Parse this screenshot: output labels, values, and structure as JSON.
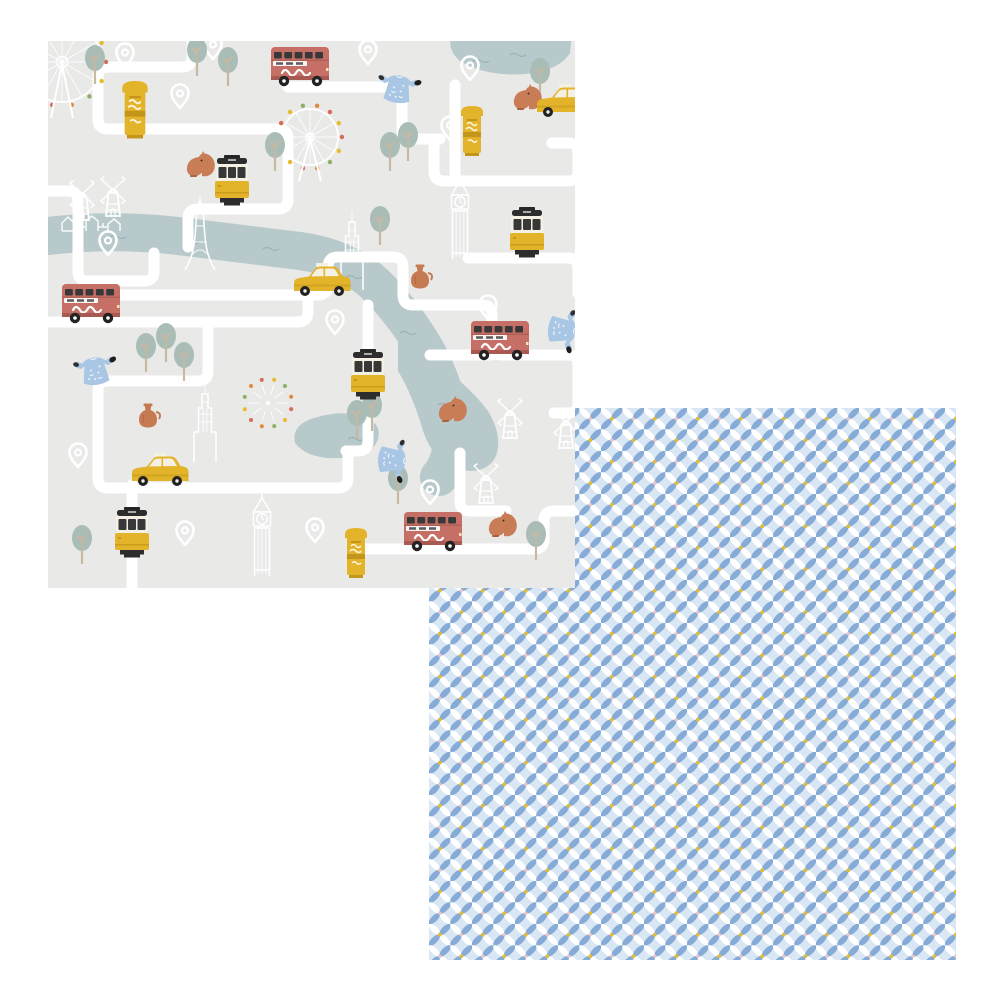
{
  "page": {
    "background": "#ffffff"
  },
  "map_sheet": {
    "name": "london-city-map-paper",
    "position": {
      "x": 48,
      "y": 41,
      "width": 527,
      "height": 547
    },
    "colors": {
      "bg": "#e9e9e8",
      "road": "#ffffff",
      "water": "#b7c9cb",
      "wave": "#9bb2b6",
      "tree": "#a9bdb6",
      "trunk": "#c9b8a1",
      "outline": "#ffffff",
      "bus_red": "#c56f66",
      "bus_dark": "#a85a52",
      "window": "#383838",
      "yellow": "#e3b32a",
      "yellow_dark": "#c3951a",
      "cream": "#f4f0e4",
      "squirrel": "#c87d56",
      "squirrel_dark": "#a9623e",
      "dress": "#a9c6e4",
      "vase": "#c57a52",
      "black": "#262626",
      "ferris_dots": [
        "#d96a5a",
        "#e7bb2e",
        "#8fae66",
        "#e0883b"
      ]
    },
    "river": {
      "path": "M-8 196 Q60 187 130 195 Q205 204 252 210 Q302 217 332 248 Q362 280 381 315 Q399 350 403 385 Q407 417 391 436",
      "width": 38,
      "wedge": "M350 300 Q410 330 440 370 Q455 395 448 415 Q438 435 410 428 Q385 420 375 390 Q365 355 350 330 Z"
    },
    "ponds": [
      "M404 -8 Q398 8 412 20 Q438 36 478 33 Q512 29 522 12 L524 -8 Z",
      "M247 402 Q243 384 266 377 Q295 368 317 376 Q334 383 330 398 Q325 414 294 417 Q260 419 247 402 Z"
    ],
    "waves": [
      [
        62,
        196
      ],
      [
        135,
        201
      ],
      [
        215,
        208
      ],
      [
        298,
        236
      ],
      [
        352,
        292
      ],
      [
        390,
        364
      ],
      [
        300,
        398
      ],
      [
        462,
        14
      ],
      [
        425,
        20
      ]
    ],
    "roads": [
      "M144 -6 V16 Q144 26 134 26 H60 Q50 26 50 36 V78 Q50 88 60 88 H230 Q240 88 240 98 V136",
      "M240 46 H344 Q354 46 354 56 V88 Q354 98 364 98 H392",
      "M392 98 Q386 98 386 108 V130 Q386 140 396 140 H520 Q530 140 530 130 V112 Q530 102 520 102 H504",
      "M407 44 V136",
      "M-6 150 H20 Q30 150 30 160 V230 Q30 240 40 240 H96 Q106 240 106 230 V212",
      "M20 254 H270 Q280 254 280 244 V226 Q280 216 290 216 H345 Q355 216 355 226 V254 Q355 264 365 264 H434",
      "M-6 281 H250 Q260 281 260 271 V258",
      "M160 282 V330 Q160 340 150 340 H60 Q50 340 50 350 V437 Q50 447 60 447 H290 Q300 447 300 437 V412",
      "M320 264 V400 Q320 410 310 410 H298",
      "M434 264 Q444 264 444 274 V304 Q444 314 454 314 H520 Q530 314 530 324 V362",
      "M382 314 H444",
      "M84 444 V547",
      "M312 508 H486 Q496 508 496 498 V480 Q496 470 506 470 H530",
      "M412 412 V460 Q412 470 422 470 H458",
      "M530 362 Q530 372 520 372 H506",
      "M240 136 V158 Q240 168 230 168 H150 Q140 168 140 178 V206",
      "M420 217 H520 Q530 217 530 227 V252"
    ],
    "motifs": {
      "trees": [
        [
          47,
          29
        ],
        [
          149,
          21
        ],
        [
          180,
          31
        ],
        [
          227,
          116
        ],
        [
          332,
          190
        ],
        [
          342,
          116
        ],
        [
          360,
          106
        ],
        [
          492,
          42
        ],
        [
          98,
          317
        ],
        [
          118,
          307
        ],
        [
          136,
          326
        ],
        [
          309,
          384
        ],
        [
          324,
          376
        ],
        [
          34,
          509
        ],
        [
          350,
          449
        ],
        [
          488,
          505
        ]
      ],
      "pins": [
        [
          77,
          17
        ],
        [
          165,
          9
        ],
        [
          132,
          58
        ],
        [
          320,
          14
        ],
        [
          422,
          30
        ],
        [
          402,
          90
        ],
        [
          60,
          205
        ],
        [
          287,
          284
        ],
        [
          440,
          269
        ],
        [
          30,
          417
        ],
        [
          137,
          495
        ],
        [
          267,
          492
        ],
        [
          382,
          454
        ]
      ],
      "postboxes": [
        [
          87,
          71,
          1.15
        ],
        [
          424,
          92,
          1
        ],
        [
          308,
          514,
          1
        ]
      ],
      "buses": [
        [
          252,
          26
        ],
        [
          43,
          263
        ],
        [
          452,
          300
        ],
        [
          385,
          491
        ]
      ],
      "trams": [
        [
          184,
          142
        ],
        [
          479,
          194
        ],
        [
          320,
          336
        ],
        [
          84,
          494
        ]
      ],
      "taxis": [
        [
          274,
          241
        ],
        [
          517,
          62
        ],
        [
          112,
          431
        ]
      ],
      "squirrels": [
        [
          150,
          126
        ],
        [
          477,
          59
        ],
        [
          402,
          371
        ],
        [
          452,
          486
        ]
      ],
      "dresses": [
        [
          350,
          47,
          8
        ],
        [
          47,
          329,
          -8
        ],
        [
          515,
          289,
          96
        ],
        [
          345,
          419,
          94
        ]
      ],
      "vases": [
        [
          372,
          237
        ],
        [
          100,
          376
        ]
      ],
      "windmills": [
        [
          34,
          159
        ],
        [
          65,
          155
        ],
        [
          462,
          377
        ],
        [
          518,
          387
        ],
        [
          438,
          442
        ]
      ],
      "big_bens": [
        [
          412,
          182
        ],
        [
          214,
          499
        ]
      ],
      "empire_states": [
        [
          304,
          209
        ],
        [
          157,
          381
        ]
      ],
      "eiffel_towers": [
        [
          152,
          193
        ]
      ],
      "ferris_wheels": [
        [
          14,
          21,
          40
        ],
        [
          262,
          96,
          28
        ]
      ],
      "fireworks": [
        [
          220,
          362,
          24
        ]
      ],
      "house_rows": [
        [
          14,
          178
        ]
      ]
    }
  },
  "pattern_sheet": {
    "name": "blue-geometric-lattice-paper",
    "position": {
      "x": 429,
      "y": 408,
      "width": 527,
      "height": 552
    },
    "cell_size": 21.5,
    "colors": {
      "bg": "#d9e6f3",
      "petal_blue": "#86abd7",
      "petal_white": "#ffffff",
      "dot_yellow": "#e4bd34",
      "dot_pink": "#efc4c4"
    }
  }
}
